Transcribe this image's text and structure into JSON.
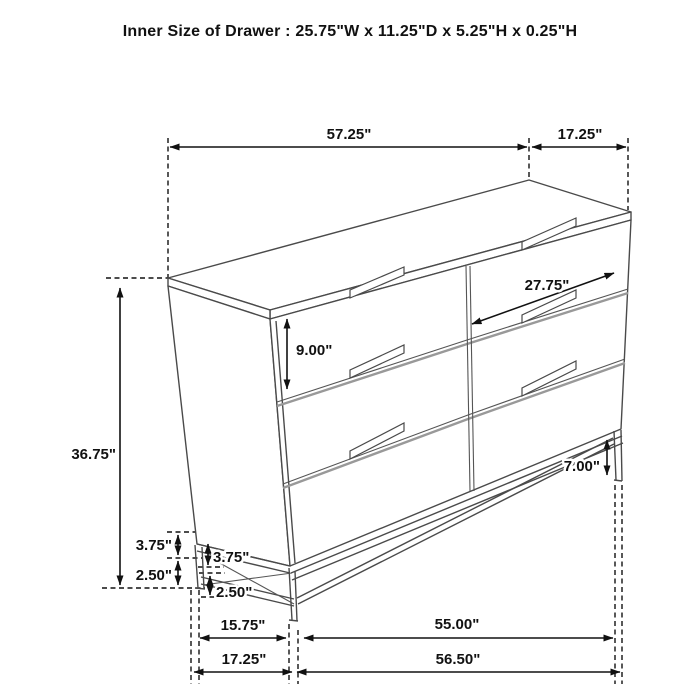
{
  "title": "Inner Size of Drawer : 25.75\"W x 11.25\"D x 5.25\"H x 0.25\"H",
  "dims": {
    "top_width": "57.25\"",
    "top_depth": "17.25\"",
    "overall_height": "36.75\"",
    "drawer_face_height": "9.00\"",
    "drawer_width": "27.75\"",
    "base_height_right": "7.00\"",
    "leg_upper_back": "3.75\"",
    "leg_upper_front": "3.75\"",
    "leg_lower_back": "2.50\"",
    "leg_lower_front": "2.50\"",
    "base_side_inner": "15.75\"",
    "base_side_outer": "17.25\"",
    "base_front_inner": "55.00\"",
    "base_front_outer": "56.50\""
  },
  "figure": {
    "type": "furniture-dimension-drawing",
    "item": "6-drawer dresser on metal base, perspective view",
    "drawer_layout": "2 columns x 3 rows"
  },
  "colors": {
    "dimension": "#111111",
    "furniture_line": "#4a4a4a",
    "drawer_gap": "#999999",
    "background": "#ffffff"
  }
}
